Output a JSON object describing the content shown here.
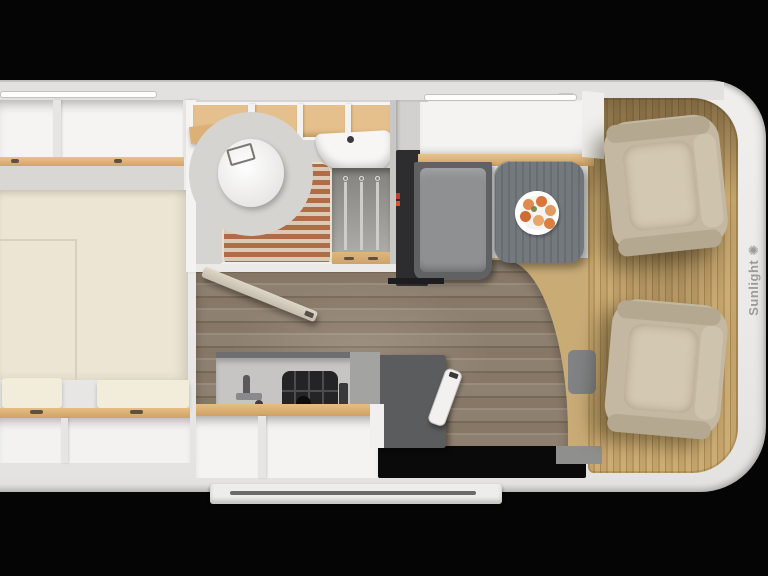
{
  "brand": {
    "name": "Sunlight",
    "logo_glyph": "✺"
  },
  "floorplan": {
    "vehicle_type": "motorhome top-view floor plan",
    "components": [
      "rear-bed",
      "overhead-lockers-top",
      "overhead-lockers-bottom",
      "bathroom",
      "toilet",
      "shower-slats",
      "washbasin",
      "wardrobe-hangers",
      "bathroom-door-open",
      "fridge-tower",
      "kitchen-counter",
      "sink-faucet",
      "gas-hob",
      "dinette-bench",
      "dinette-table",
      "fruit-plate",
      "side-seat",
      "entry-door-step",
      "cab-floor-mat",
      "driver-seat-swivel",
      "passenger-seat-swivel",
      "led-light-strips"
    ],
    "colors": {
      "background": "#050505",
      "body_white": "#efeeec",
      "mattress_cream": "#ece5d3",
      "wood_trim": "#e5bd83",
      "shower_slats": "#b06c47",
      "corridor_floor": "#8b7c6d",
      "cab_mat": "#c3a26a",
      "seat_beige": "#c5b8a2",
      "bench_grey": "#8f9092",
      "table_grey": "#70757a",
      "fridge_dark": "#2d2c2e",
      "accent_red": "#c33b2f",
      "fruit_orange": "#dd8143",
      "brand_text": "#9b9b9b"
    }
  }
}
